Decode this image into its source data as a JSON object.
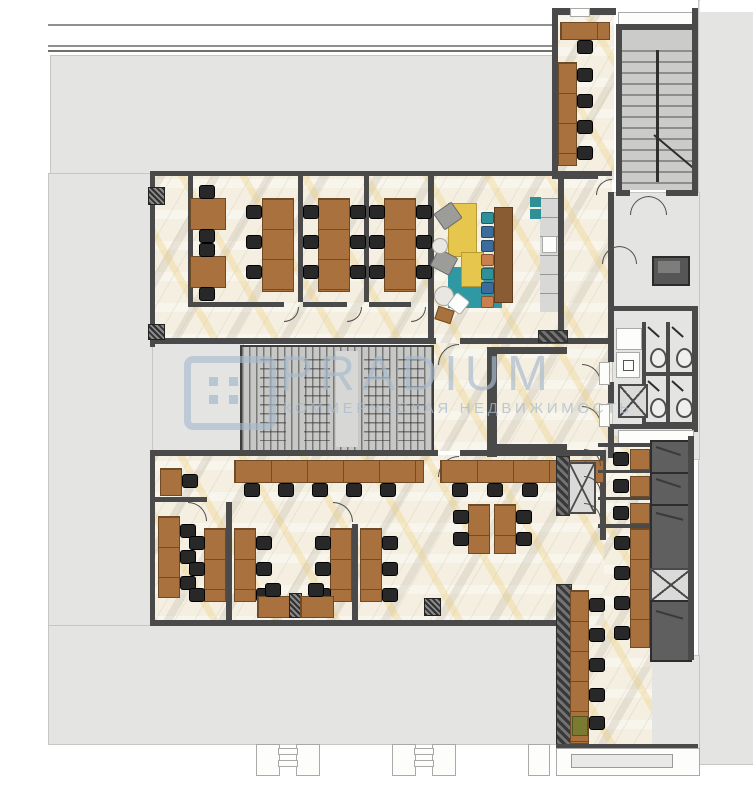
{
  "watermark": {
    "brand": "PRADIUM",
    "tagline": "КОММЕРЧЕСКАЯ НЕДВИЖИМОСТЬ",
    "color": "#a7bacd"
  },
  "palette": {
    "floor": "#f4efe1",
    "concrete": "#e4e5e3",
    "wall": "#4a4a4a",
    "wood": "#a8713d",
    "wood_dark": "#8a5c33",
    "chair": "#282828",
    "sofa": "#e7c64e",
    "rug": "#2f98a2",
    "stool_teal": "#2f9097",
    "stool_blue": "#3b6d9c",
    "stool_orange": "#c8804f",
    "stair": "#cbccca",
    "dark_room": "#5f5f5f"
  },
  "lounge": {
    "stool_colors": [
      "teal",
      "blue",
      "blue",
      "orange",
      "teal",
      "blue",
      "orange"
    ]
  },
  "fixtures": {
    "wc_stalls": 4,
    "toilets": 4,
    "phone_booths": 3,
    "shafts_marked_x": 3
  }
}
